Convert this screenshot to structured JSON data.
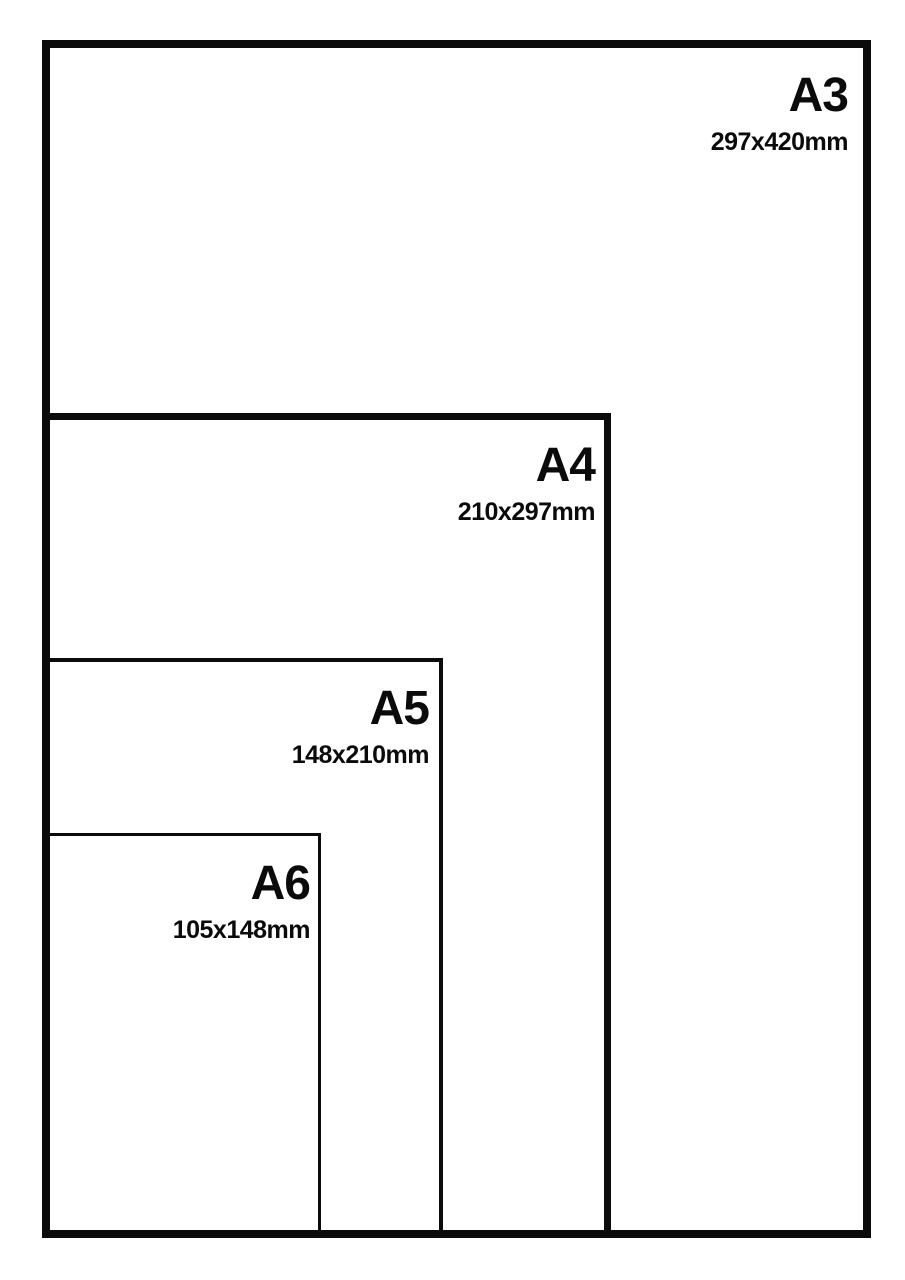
{
  "diagram": {
    "type": "paper-size-comparison",
    "sizes": [
      {
        "name": "A3",
        "dimensions": "297x420mm"
      },
      {
        "name": "A4",
        "dimensions": "210x297mm"
      },
      {
        "name": "A5",
        "dimensions": "148x210mm"
      },
      {
        "name": "A6",
        "dimensions": "105x148mm"
      }
    ],
    "colors": {
      "line": "#0b0b0b",
      "text": "#0b0b0b",
      "background": "#ffffff"
    }
  }
}
